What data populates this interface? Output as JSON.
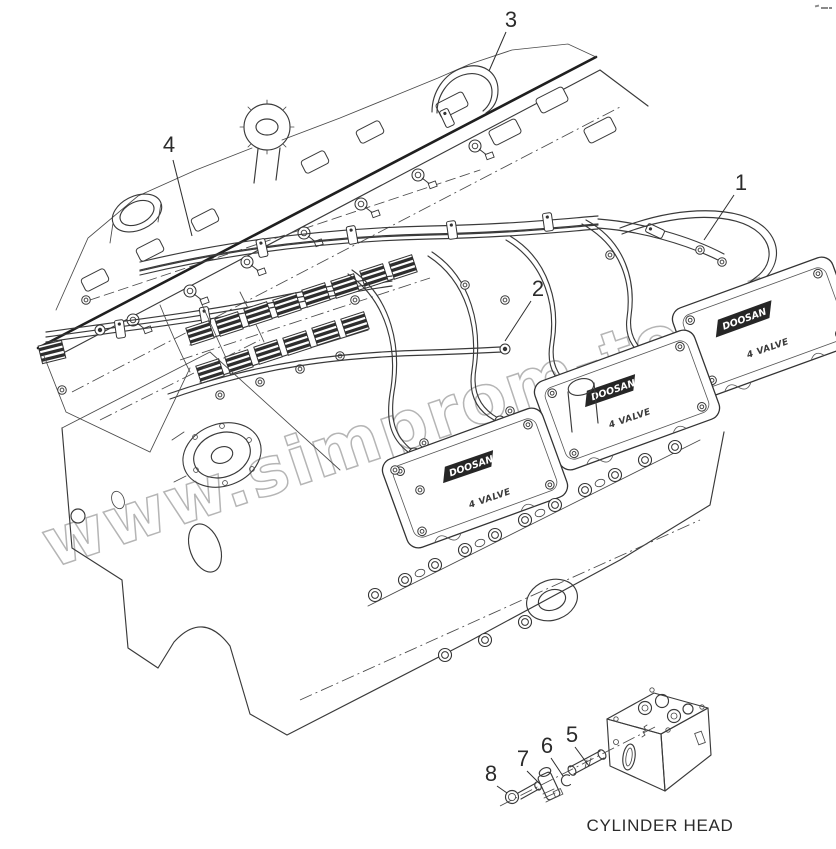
{
  "diagram": {
    "callouts": [
      "1",
      "2",
      "3",
      "4",
      "5",
      "6",
      "7",
      "8"
    ],
    "caption": "CYLINDER HEAD",
    "watermark": "www.simprom-too.kz",
    "brand_badge": "DOOSAN",
    "brand_subtext": "4 VALVE",
    "line_color": "#3a3a3a",
    "watermark_color": "#a5a5a5",
    "background": "#ffffff"
  }
}
